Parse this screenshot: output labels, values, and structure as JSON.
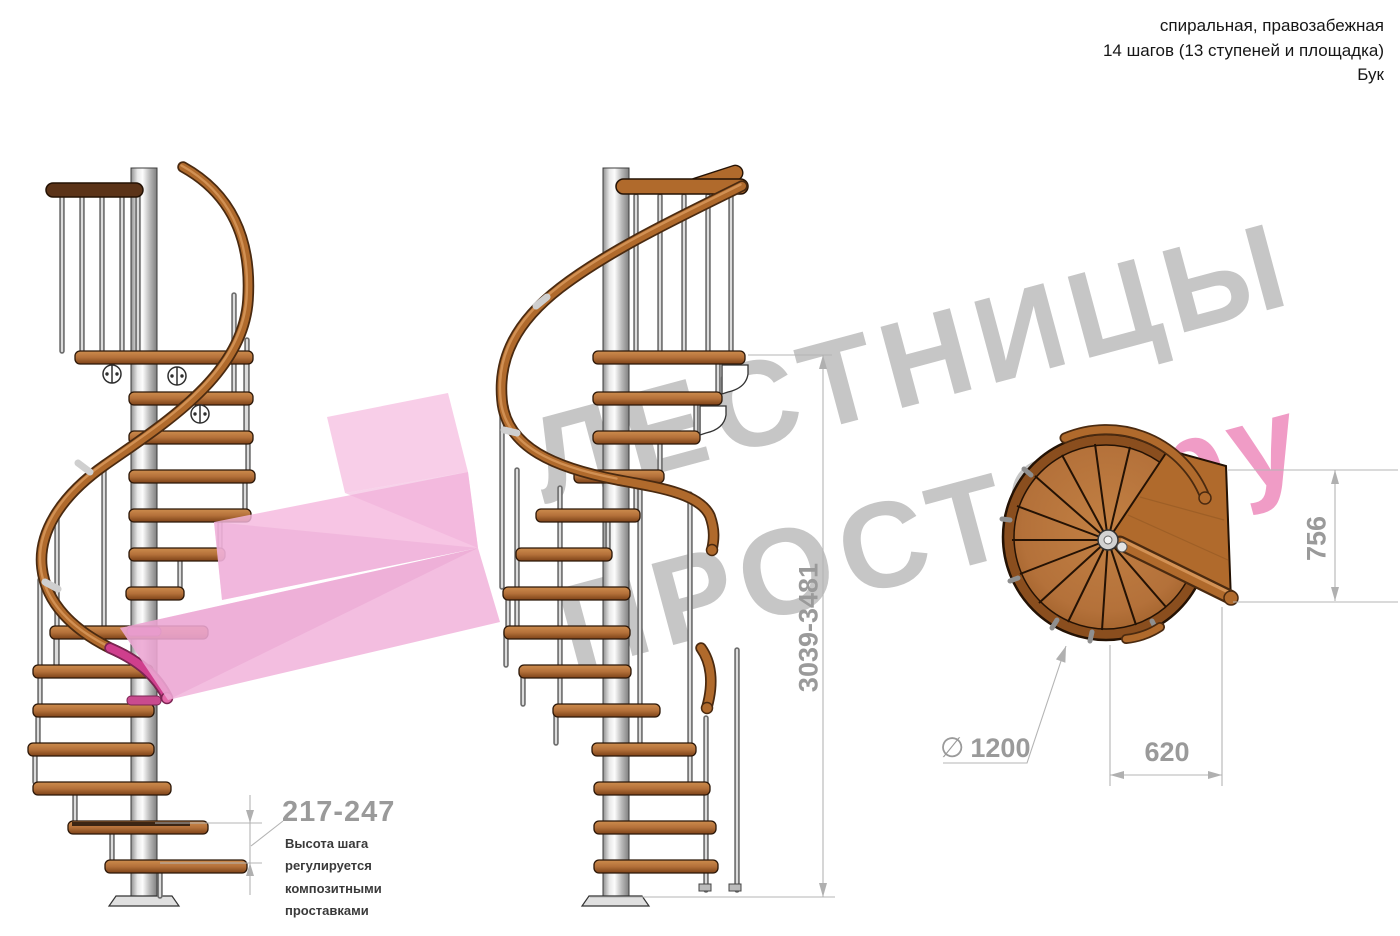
{
  "header": {
    "line1": "спиральная, правозабежная",
    "line2": "14 шагов (13 ступеней и площадка)",
    "line3": "Бук"
  },
  "watermark": {
    "line1": "ЛЕСТНИЦЫ",
    "line2_gray": "ПРОСТО",
    "line2_pink": ".ру"
  },
  "dimensions": {
    "step_height": {
      "value": "217-247",
      "note_lines": [
        "Высота шага",
        "регулируется",
        "композитными",
        "проставками"
      ]
    },
    "total_height": "3039-3481",
    "plan_depth": "756",
    "plan_width": "620",
    "plan_diameter_symbol": "∅",
    "plan_diameter": "1200"
  },
  "colors": {
    "wood": "#b4713a",
    "rail_wood": "#b06a2c",
    "metal": "#c9c9c9",
    "watermark_gray": "#c6c6c6",
    "watermark_pink": "#f09cc6",
    "highlight_arrow_pink": "#f3b1da",
    "highlight_magenta": "#cf3f8d",
    "dimension_gray": "#9a9a9a"
  }
}
